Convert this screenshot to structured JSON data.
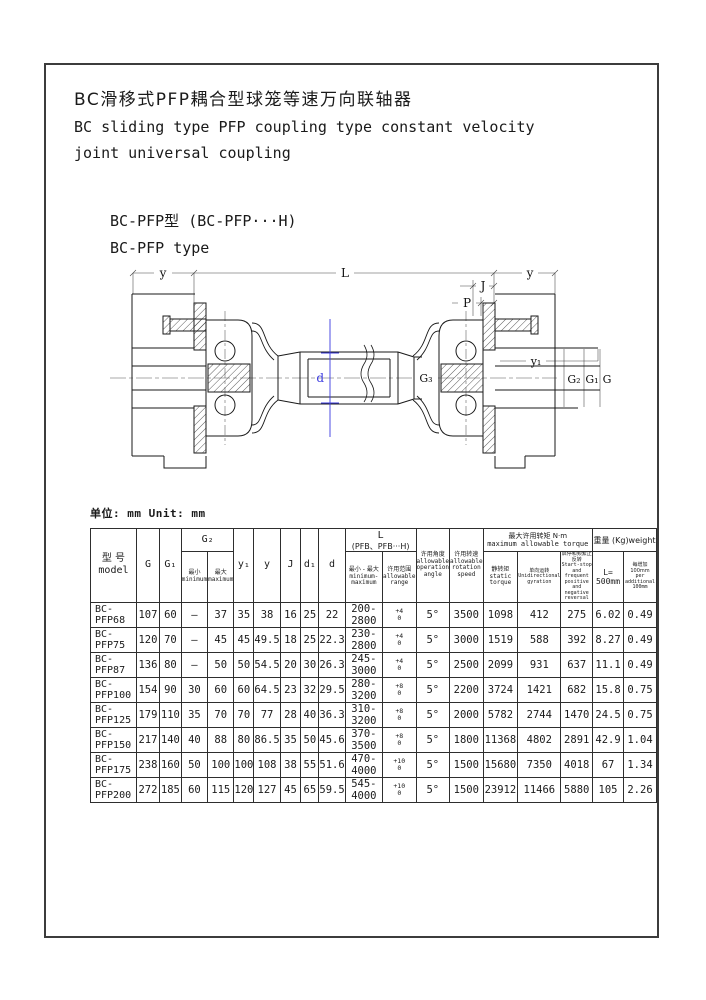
{
  "page": {
    "title_zh": "BC滑移式PFP耦合型球笼等速万向联轴器",
    "title_en_line1": "BC sliding type PFP coupling type constant velocity",
    "title_en_line2": "joint universal coupling",
    "subtitle_zh": "BC-PFP型  (BC-PFP···H)",
    "subtitle_en": "BC-PFP type",
    "unit_note": "单位: mm Unit: mm"
  },
  "colors": {
    "accent_blue": "#3b3be0",
    "ink": "#1a1a1a",
    "frame_border": "#3c3c3c"
  },
  "drawing": {
    "labels": {
      "y_left": "y",
      "length": "L",
      "y_right": "y",
      "j": "J",
      "p": "P",
      "y1": "y₁",
      "g3": "G₃",
      "g2": "G₂",
      "g1": "G₁",
      "g": "G",
      "d": "d"
    }
  },
  "table": {
    "headers": {
      "model_zh": "型 号",
      "model_en": "model",
      "g": "G",
      "g1": "G₁",
      "g2": "G₂",
      "min_zh": "最小",
      "min_en": "minimum",
      "max_zh": "最大",
      "max_en": "maximum",
      "y1": "y₁",
      "y": "y",
      "j": "J",
      "d1": "d₁",
      "d": "d",
      "l_line1": "L",
      "l_line2": "(PFB、PFB···H)",
      "l_minmax_zh": "最小 - 最大",
      "l_minmax_en": "minimum-maximum",
      "l_range_zh": "许用范围",
      "l_range_en": "allowable range",
      "angle_zh": "许用角度",
      "angle_en1": "allowable",
      "angle_en2": "operation",
      "angle_en3": "angle",
      "speed_zh": "许用转速",
      "speed_en1": "allowable",
      "speed_en2": "rotation",
      "speed_en3": "speed",
      "torque_zh": "最大许用转矩  N·m",
      "torque_en": "maximum allowable torque",
      "static_zh": "静转矩",
      "static_en": "static torque",
      "unidir_zh": "单向运转",
      "unidir_en1": "Unidirectional",
      "unidir_en2": "gyration",
      "reversal_zh": "启停和频繁正反转",
      "reversal_en1": "Start-stop and",
      "reversal_en2": "frequent positive",
      "reversal_en3": "and negative reversal",
      "weight_group": "重量 (Kg)weight",
      "w500_line1": "L=",
      "w500_line2": "500mm",
      "wper_zh": "每增加 100mm",
      "wper_en1": "per additional",
      "wper_en2": "100mm"
    },
    "rows": [
      {
        "model": "BC-PFP68",
        "g": "107",
        "g1": "60",
        "g2min": "—",
        "g2max": "37",
        "y1": "35",
        "y": "38",
        "j": "16",
        "d1": "25",
        "d": "22",
        "l": "200-2800",
        "tol_top": "+4",
        "tol_bot": "0",
        "angle": "5°",
        "speed": "3500",
        "static": "1098",
        "unidir": "412",
        "reversal": "275",
        "w500": "6.02",
        "wper": "0.49"
      },
      {
        "model": "BC-PFP75",
        "g": "120",
        "g1": "70",
        "g2min": "—",
        "g2max": "45",
        "y1": "45",
        "y": "49.5",
        "j": "18",
        "d1": "25",
        "d": "22.3",
        "l": "230-2800",
        "tol_top": "+4",
        "tol_bot": "0",
        "angle": "5°",
        "speed": "3000",
        "static": "1519",
        "unidir": "588",
        "reversal": "392",
        "w500": "8.27",
        "wper": "0.49"
      },
      {
        "model": "BC-PFP87",
        "g": "136",
        "g1": "80",
        "g2min": "—",
        "g2max": "50",
        "y1": "50",
        "y": "54.5",
        "j": "20",
        "d1": "30",
        "d": "26.3",
        "l": "245-3000",
        "tol_top": "+4",
        "tol_bot": "0",
        "angle": "5°",
        "speed": "2500",
        "static": "2099",
        "unidir": "931",
        "reversal": "637",
        "w500": "11.1",
        "wper": "0.49"
      },
      {
        "model": "BC-PFP100",
        "g": "154",
        "g1": "90",
        "g2min": "30",
        "g2max": "60",
        "y1": "60",
        "y": "64.5",
        "j": "23",
        "d1": "32",
        "d": "29.5",
        "l": "280-3200",
        "tol_top": "+8",
        "tol_bot": "0",
        "angle": "5°",
        "speed": "2200",
        "static": "3724",
        "unidir": "1421",
        "reversal": "682",
        "w500": "15.8",
        "wper": "0.75"
      },
      {
        "model": "BC-PFP125",
        "g": "179",
        "g1": "110",
        "g2min": "35",
        "g2max": "70",
        "y1": "70",
        "y": "77",
        "j": "28",
        "d1": "40",
        "d": "36.3",
        "l": "310-3200",
        "tol_top": "+8",
        "tol_bot": "0",
        "angle": "5°",
        "speed": "2000",
        "static": "5782",
        "unidir": "2744",
        "reversal": "1470",
        "w500": "24.5",
        "wper": "0.75"
      },
      {
        "model": "BC-PFP150",
        "g": "217",
        "g1": "140",
        "g2min": "40",
        "g2max": "88",
        "y1": "80",
        "y": "86.5",
        "j": "35",
        "d1": "50",
        "d": "45.6",
        "l": "370-3500",
        "tol_top": "+8",
        "tol_bot": "0",
        "angle": "5°",
        "speed": "1800",
        "static": "11368",
        "unidir": "4802",
        "reversal": "2891",
        "w500": "42.9",
        "wper": "1.04"
      },
      {
        "model": "BC-PFP175",
        "g": "238",
        "g1": "160",
        "g2min": "50",
        "g2max": "100",
        "y1": "100",
        "y": "108",
        "j": "38",
        "d1": "55",
        "d": "51.6",
        "l": "470-4000",
        "tol_top": "+10",
        "tol_bot": "0",
        "angle": "5°",
        "speed": "1500",
        "static": "15680",
        "unidir": "7350",
        "reversal": "4018",
        "w500": "67",
        "wper": "1.34"
      },
      {
        "model": "BC-PFP200",
        "g": "272",
        "g1": "185",
        "g2min": "60",
        "g2max": "115",
        "y1": "120",
        "y": "127",
        "j": "45",
        "d1": "65",
        "d": "59.5",
        "l": "545-4000",
        "tol_top": "+10",
        "tol_bot": "0",
        "angle": "5°",
        "speed": "1500",
        "static": "23912",
        "unidir": "11466",
        "reversal": "5880",
        "w500": "105",
        "wper": "2.26"
      }
    ]
  }
}
